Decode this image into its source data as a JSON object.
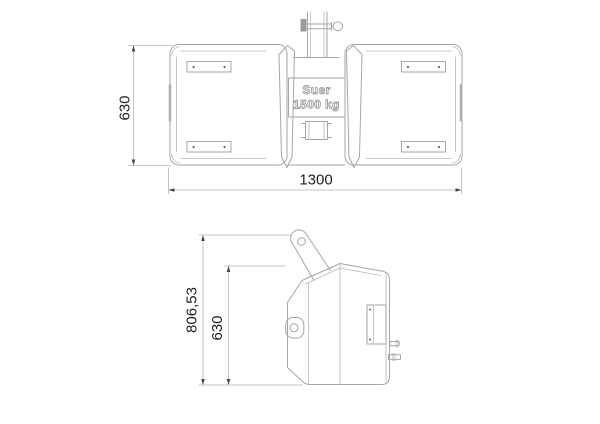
{
  "drawing": {
    "label_plate": {
      "brand": "Suer",
      "weight": "1500 kg"
    },
    "front_view": {
      "height": "630",
      "width": "1300"
    },
    "side_view": {
      "overall_height": "806,53",
      "body_height": "630"
    },
    "colors": {
      "background": "#ffffff",
      "outline": "#a6a6a6",
      "dimension_line": "#c4c4c4",
      "dimension_text": "#1f1f1f",
      "label_text": "#8f8f8f"
    }
  }
}
